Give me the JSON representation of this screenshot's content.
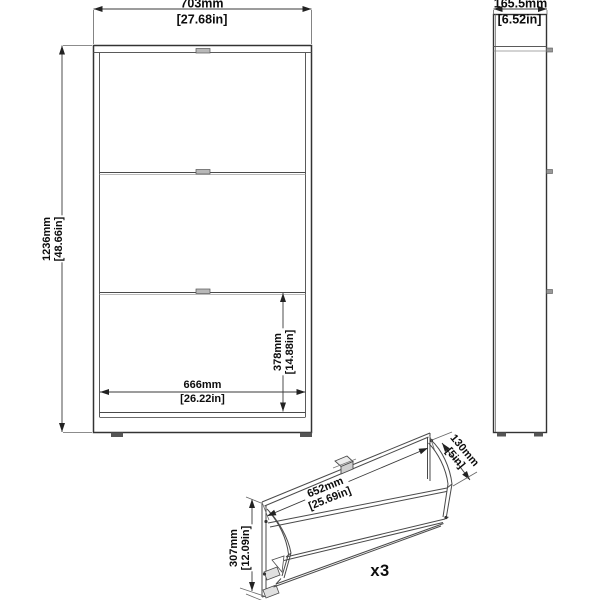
{
  "canvas": {
    "bg": "#ffffff",
    "line_color": "#4a4a4a",
    "edge_color": "#333333",
    "handle_fill": "#b8b8b8",
    "foot_fill": "#555555"
  },
  "front_view": {
    "width": {
      "mm": "703mm",
      "inches": "[27.68in]"
    },
    "height": {
      "mm": "1236mm",
      "inches": "[48.66in]"
    },
    "inner_width": {
      "mm": "666mm",
      "inches": "[26.22in]"
    },
    "compartment_height": {
      "mm": "378mm",
      "inches": "[14.88in]"
    }
  },
  "side_view": {
    "depth": {
      "mm": "165.5mm",
      "inches": "[6.52in]"
    }
  },
  "flap_view": {
    "width": {
      "mm": "652mm",
      "inches": "[25.69in]"
    },
    "depth": {
      "mm": "130mm",
      "inches": "[5in]"
    },
    "height": {
      "mm": "307mm",
      "inches": "[12.09in]"
    },
    "quantity": "x3"
  }
}
